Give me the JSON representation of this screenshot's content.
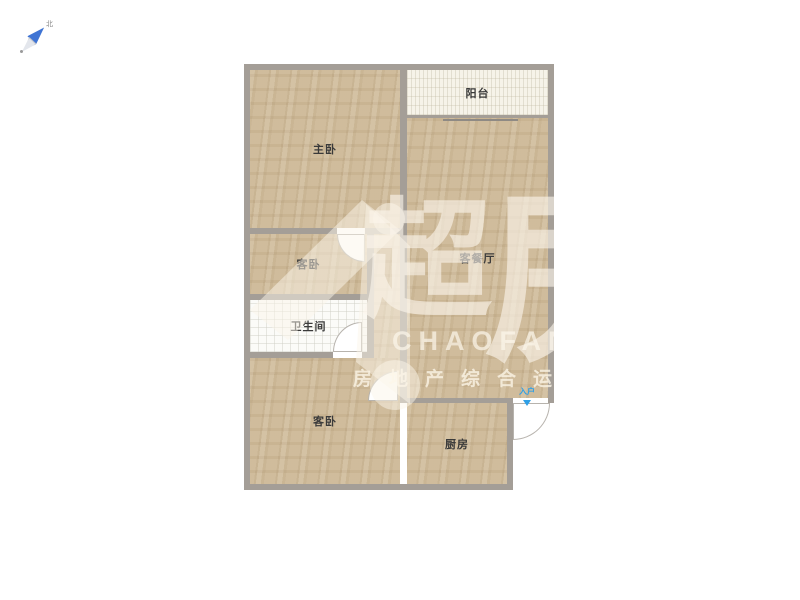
{
  "compass": {
    "north_label": "北"
  },
  "floor_plan": {
    "rooms": [
      {
        "name": "master-bedroom",
        "label": "主卧"
      },
      {
        "name": "balcony",
        "label": "阳台"
      },
      {
        "name": "living-dining-room",
        "label": "客餐厅"
      },
      {
        "name": "guest-bedroom-middle",
        "label": "客卧"
      },
      {
        "name": "bathroom",
        "label": "卫生间"
      },
      {
        "name": "guest-bedroom-bottom",
        "label": "客卧"
      },
      {
        "name": "kitchen",
        "label": "厨房"
      }
    ],
    "entrance_label": "入户",
    "colors": {
      "wall": "#a49e97",
      "room_fill": "#ccb795",
      "balcony_fill": "#f6f3e9",
      "bathroom_fill": "#fbfbf8",
      "entrance_marker": "#2e9fe6",
      "label_text": "#3a3a3a"
    }
  },
  "watermark": {
    "brand_char_left": "超",
    "brand_char_right": "房",
    "brand_en": "CHAOFANG",
    "slogan": "房地产综合运"
  }
}
